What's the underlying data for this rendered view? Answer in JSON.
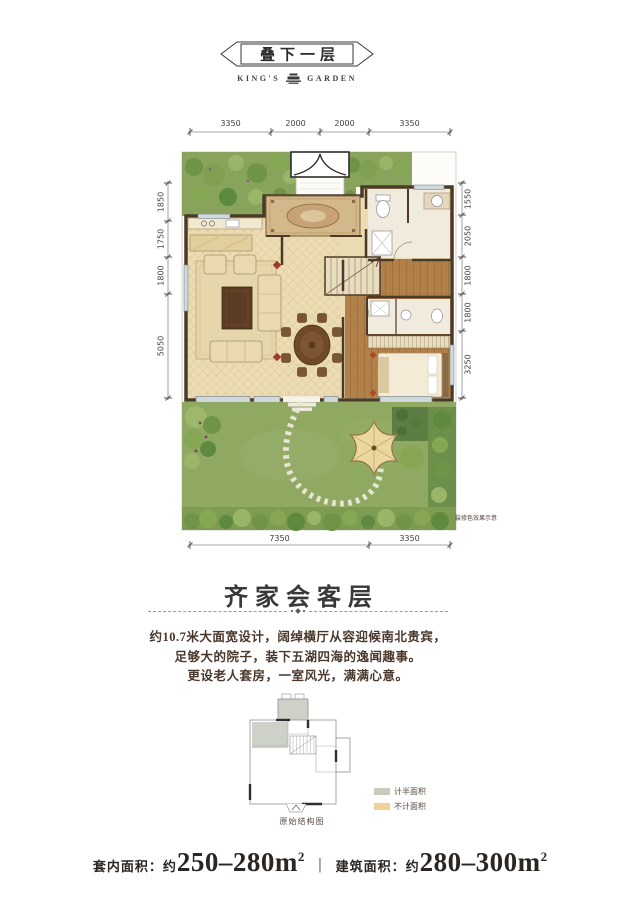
{
  "header": {
    "title": "叠下一层",
    "brand_left": "KING'S",
    "brand_right": "GARDEN"
  },
  "plan": {
    "dims_top": [
      "3350",
      "2000",
      "2000",
      "3350"
    ],
    "dims_left": [
      "1850",
      "1750",
      "1800",
      "5050"
    ],
    "dims_right": [
      "1550",
      "2050",
      "1800",
      "1800",
      "3250"
    ],
    "dims_bottom": [
      "7350",
      "3350"
    ],
    "note": "装修色效果示意"
  },
  "section": {
    "title": "齐家会客层",
    "description_lines": [
      "约10.7米大面宽设计，阔绰横厅从容迎候南北贵宾，",
      "足够大的院子，装下五湖四海的逸闻趣事。",
      "更设老人套房，一室风光，满满心意。"
    ]
  },
  "schematic": {
    "caption": "原始结构图",
    "legend": [
      {
        "label": "计半面积",
        "color": "#c6cbbc"
      },
      {
        "label": "不计面积",
        "color": "#f2d09c"
      }
    ]
  },
  "footer": {
    "items": [
      {
        "label": "套内面积：",
        "approx": "约",
        "value": "250–280m",
        "sup": "2"
      },
      {
        "label": "建筑面积：",
        "approx": "约",
        "value": "280–300m",
        "sup": "2"
      }
    ],
    "divider": "|"
  },
  "colors": {
    "wall": "#4c3a28",
    "floor": "#ecdcb2",
    "lawn": "#8fa963",
    "wood": "#b28049",
    "accent_text": "#4b382c"
  }
}
